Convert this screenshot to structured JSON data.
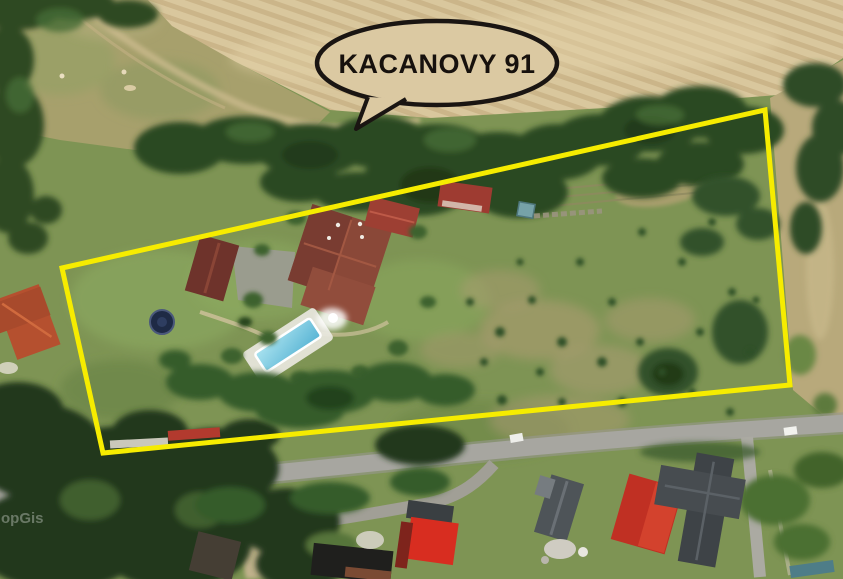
{
  "callout": {
    "label": "KACANOVY 91"
  },
  "watermark": {
    "text": "opGis"
  },
  "boundary": {
    "points": "62,268 765,110 790,385 103,453",
    "color": "#F6EC00",
    "stroke_width": 5
  },
  "colors": {
    "boundary_yellow": "#F6EC00",
    "bubble_outline": "#1A1512",
    "bubble_fill": "#DBC9A2",
    "wheat_field": "#D9C79D",
    "dry_meadow": "#A7A06C",
    "lawn_green": "#7E9454",
    "tree_dark": "#22381B",
    "road_gray": "#A7A6A0",
    "main_house_roof": "#8A4838",
    "house_lower_wing": "#914D3C",
    "outbuilding_roof": "#9D3F33",
    "garage_roof": "#6E332B",
    "playhouse_roof": "#9E3B31",
    "left_house_roof": "#B5502F",
    "red_house_roof": "#D82D20",
    "big_red_roof": "#C03023",
    "gray_house_roof": "#4E5458",
    "anthracite_roof": "#3E4347",
    "dark_shed_roof": "#453E34",
    "black_building": "#1F1F1D",
    "pool_water": "#7FCBE4",
    "pool_deck": "#E9E7DF",
    "trampoline": "#1E2A45",
    "outside_field_tan": "#B8A97B"
  }
}
